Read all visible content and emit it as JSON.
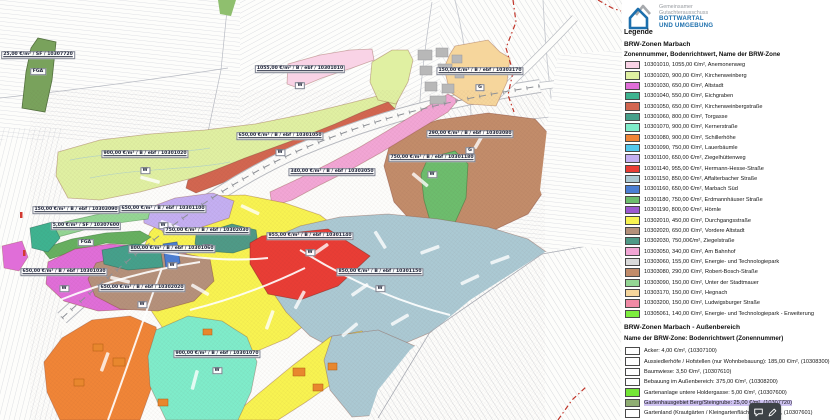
{
  "brand": {
    "line1": "Gemeinsamer",
    "line2": "Gutachterausschuss",
    "line3": "BOTTWARTAL",
    "line4": "UND UMGEBUNG",
    "accent_color": "#1c6fad",
    "gray_color": "#989ca1"
  },
  "legend": {
    "title": "Legende",
    "zones": {
      "title": "BRW-Zonen Marbach",
      "subtitle": "Zonennummer, Bodenrichtwert, Name der BRW-Zone",
      "items": [
        {
          "zone": "10301010",
          "color": "#f9d3e6",
          "label": "10301010, 1055,00 €/m², Anemonenweg"
        },
        {
          "zone": "10301020",
          "color": "#e0f0a2",
          "label": "10301020, 900,00 €/m², Kirchenweinberg"
        },
        {
          "zone": "10301030",
          "color": "#e06ed8",
          "label": "10301030, 650,00 €/m², Altstadt"
        },
        {
          "zone": "10301040",
          "color": "#3eb390",
          "label": "10301040, 550,00 €/m², Eichgraben"
        },
        {
          "zone": "10301050",
          "color": "#d26650",
          "label": "10301050, 650,00 €/m², Kirchenweinbergstraße"
        },
        {
          "zone": "10301060",
          "color": "#45a08b",
          "label": "10301060, 800,00 €/m², Torgasse"
        },
        {
          "zone": "10301070",
          "color": "#7fecca",
          "label": "10301070, 900,00 €/m², Kernerstraße"
        },
        {
          "zone": "10301080",
          "color": "#f08537",
          "label": "10301080, 900,00 €/m², Schillerhöhe"
        },
        {
          "zone": "10301090",
          "color": "#53c9ee",
          "label": "10301090, 750,00 €/m², Lauerbäumle"
        },
        {
          "zone": "10301100",
          "color": "#c4aff2",
          "label": "10301100, 650,00 €/m², Ziegelhüttenweg"
        },
        {
          "zone": "10301140",
          "color": "#e93d35",
          "label": "10301140, 955,00 €/m², Hermann-Hesse-Straße"
        },
        {
          "zone": "10301150",
          "color": "#abc9d3",
          "label": "10301150, 850,00 €/m², Affalterbacher Straße"
        },
        {
          "zone": "10301160",
          "color": "#4b7ed3",
          "label": "10301160, 650,00 €/m², Marbach Süd"
        },
        {
          "zone": "10301180",
          "color": "#6dbd6d",
          "label": "10301180, 750,00 €/m², Erdmannhäuser Straße"
        },
        {
          "zone": "10301190",
          "color": "#9c59d0",
          "label": "10301190, 800,00 €/m², Hörnle"
        },
        {
          "zone": "10302010",
          "color": "#f8f351",
          "label": "10302010, 450,00 €/m², Durchgangsstraße"
        },
        {
          "zone": "10302020",
          "color": "#b5917b",
          "label": "10302020, 650,00 €/m², Vordere Altstadt"
        },
        {
          "zone": "10302030",
          "color": "#4f9a87",
          "label": "10302030, 750,00€/m², Ziegelstraße"
        },
        {
          "zone": "10303050",
          "color": "#f2a6d5",
          "label": "10303050, 340,00 €/m², Am Bahnhof"
        },
        {
          "zone": "10303060",
          "color": "#dadada",
          "label": "10303060, 155,00 €/m², Energie- und Technologiepark"
        },
        {
          "zone": "10303080",
          "color": "#c28c6a",
          "label": "10303080, 290,00 €/m², Robert-Bosch-Straße"
        },
        {
          "zone": "10303090",
          "color": "#94d694",
          "label": "10303090, 150,00 €/m², Unter der Stadtmauer"
        },
        {
          "zone": "10303170",
          "color": "#f6d69c",
          "label": "10303170, 150,00 €/m², Hegnach"
        },
        {
          "zone": "10303200",
          "color": "#f08aa5",
          "label": "10303200, 150,00 €/m², Ludwigsburger Straße"
        },
        {
          "zone": "10305061",
          "color": "#7ded3e",
          "label": "10305061, 140,00 €/m², Energie- und Technologiepark - Erweiterung"
        }
      ]
    },
    "aussenbereich": {
      "title": "BRW-Zonen Marbach - Außenbereich",
      "subtitle": "Name der BRW-Zone: Bodenrichtwert (Zonennummer)",
      "highlight_color": "#cfc3f2",
      "items": [
        {
          "zone": "10307100",
          "color": "#ffffff",
          "label": "Acker: 4,00 €/m², (10307100)"
        },
        {
          "zone": "10308300",
          "color": "#ffffff",
          "label": "Aussiedlerhöfe / Hofstellen (nur Wohnbebauung): 185,00 €/m², (10308300)"
        },
        {
          "zone": "10307610",
          "color": "#ffffff",
          "label": "Baumwiese: 3,50 €/m², (10307610)"
        },
        {
          "zone": "10308200",
          "color": "#ffffff",
          "label": "Bebauung im Außenbereich: 375,00 €/m², (10308200)"
        },
        {
          "zone": "10307600",
          "color": "#74e636",
          "label": "Gartenanlage untere Holdergasse: 5,00 €/m², (10307600)"
        },
        {
          "zone": "10307720",
          "color": "#8fad72",
          "label": "Gartenhausgebiet Berg/Steingrube: 25,00 €/m², (10307720)",
          "highlighted": true
        },
        {
          "zone": "10307601",
          "color": "#ffffff",
          "label": "Gartenland (Krautgärten / Kleingartenfläche): 5,00 €/m², (10307601)"
        },
        {
          "zone": "",
          "color": "#ffffff",
          "label": ""
        }
      ]
    }
  },
  "map": {
    "labels": [
      {
        "text": "25,00 €/m² / SF / 10307720",
        "tag": "FGA",
        "x": 38,
        "y": 64
      },
      {
        "text": "1055,00 €/m² / B / ebf / 10301010",
        "tag": "W",
        "x": 300,
        "y": 78
      },
      {
        "text": "150,00 €/m² / B / ebf / 10303170",
        "tag": "G",
        "x": 480,
        "y": 80
      },
      {
        "text": "650,00 €/m² / B / ebf / 10301050",
        "tag": "W",
        "x": 280,
        "y": 145
      },
      {
        "text": "290,00 €/m² / B / ebf / 10303080",
        "tag": "G",
        "x": 470,
        "y": 143
      },
      {
        "text": "900,00 €/m² / B / ebf / 10301020",
        "tag": "W",
        "x": 145,
        "y": 163
      },
      {
        "text": "750,00 €/m² / B / ebf / 10301180",
        "tag": "W",
        "x": 432,
        "y": 167
      },
      {
        "text": "340,00 €/m² / B / ebf / 10303050",
        "x": 332,
        "y": 172
      },
      {
        "text": "650,00 €/m² / B / ebf / 10301100",
        "tag": "W",
        "x": 163,
        "y": 218
      },
      {
        "text": "150,00 €/m² / B / ebf / 10303090",
        "tag": "G",
        "x": 76,
        "y": 219
      },
      {
        "text": "5,00 €/m² / SF / 10307600",
        "tag": "FGA",
        "x": 86,
        "y": 235
      },
      {
        "text": "750,00 €/m² / B / ebf / 10302030",
        "tag": "W",
        "x": 207,
        "y": 240
      },
      {
        "text": "955,00 €/m² / B / ebf / 10301140",
        "tag": "W",
        "x": 310,
        "y": 245
      },
      {
        "text": "800,00 €/m² / B / ebf / 10301060",
        "tag": "W",
        "x": 172,
        "y": 258
      },
      {
        "text": "650,00 €/m² / B / ebf / 10301030",
        "tag": "W",
        "x": 64,
        "y": 281
      },
      {
        "text": "850,00 €/m² / B / ebf / 10301150",
        "tag": "W",
        "x": 380,
        "y": 281
      },
      {
        "text": "650,00 €/m² / B / ebf / 10302020",
        "tag": "W",
        "x": 142,
        "y": 297
      },
      {
        "text": "900,00 €/m² / B / ebf / 10301070",
        "tag": "W",
        "x": 217,
        "y": 363
      }
    ]
  },
  "toolbar": {
    "icons": [
      {
        "name": "comment-icon"
      },
      {
        "name": "edit-icon"
      }
    ]
  }
}
